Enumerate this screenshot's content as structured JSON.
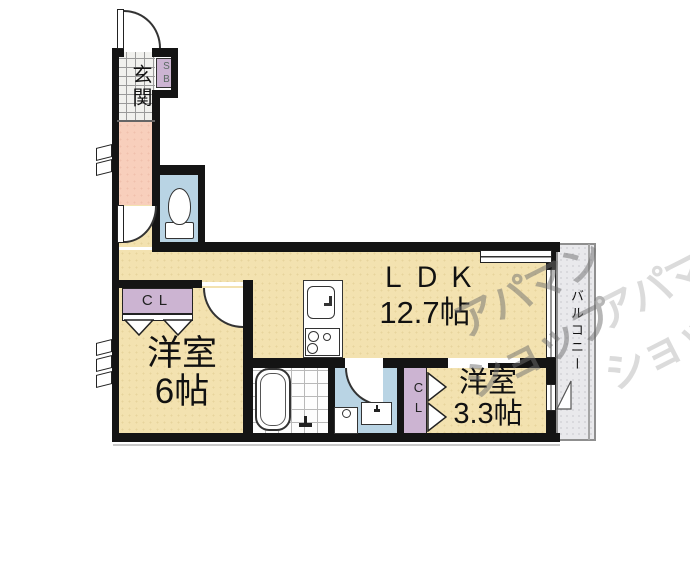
{
  "rooms": {
    "genkan": {
      "label": "玄関"
    },
    "ldk": {
      "name": "ＬＤＫ",
      "size": "12.7帖"
    },
    "bedroom_main": {
      "name": "洋室",
      "size": "6帖"
    },
    "bedroom_small": {
      "name": "洋室",
      "size": "3.3帖"
    },
    "balcony": {
      "label": "バルコニー"
    }
  },
  "storage": {
    "shoe_box": "SB",
    "closet_main": "CL",
    "closet_small": "CL"
  },
  "watermark": {
    "line1": "アパマン",
    "line2": "ショップ"
  },
  "colors": {
    "wall_black": "#141414",
    "floor_beige": "#f3e2b0",
    "hallway_pink": "#f8cfbc",
    "water_blue": "#b9d4e4",
    "closet_purple": "#ccb4d2",
    "balcony_gray": "#e9e9ec",
    "tile_line": "#9a9a9a",
    "watermark_gray": "#6e6e6e"
  }
}
